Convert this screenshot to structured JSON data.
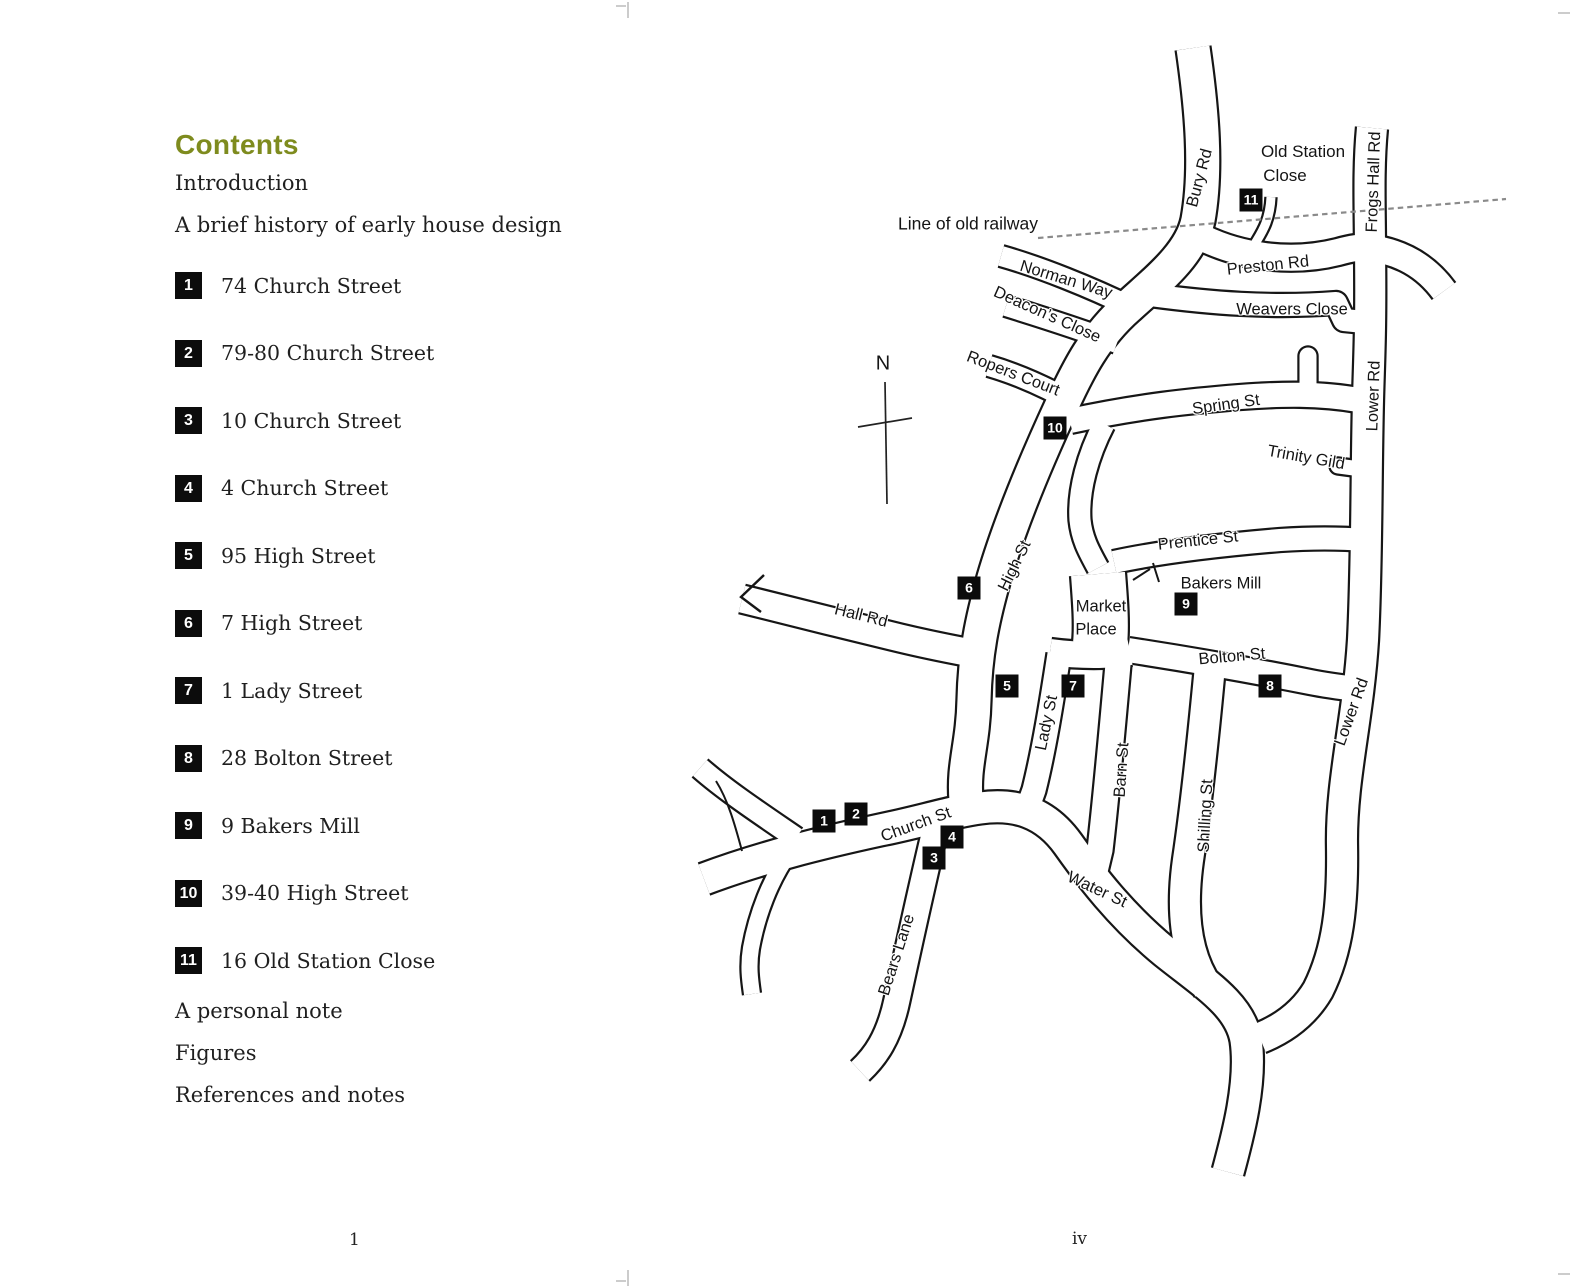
{
  "colors": {
    "accent_olive": "#7e8b1e",
    "ink": "#1f1f1f",
    "map_ink": "#161616",
    "railway_gray": "#8a8a8a"
  },
  "page_left": {
    "title": "Contents",
    "sections_before": [
      "Introduction",
      "A brief history of early house design"
    ],
    "entries": [
      {
        "num": "1",
        "label": "74 Church Street"
      },
      {
        "num": "2",
        "label": "79-80 Church Street"
      },
      {
        "num": "3",
        "label": "10 Church Street"
      },
      {
        "num": "4",
        "label": "4 Church Street"
      },
      {
        "num": "5",
        "label": "95 High Street"
      },
      {
        "num": "6",
        "label": "7 High Street"
      },
      {
        "num": "7",
        "label": "1 Lady Street"
      },
      {
        "num": "8",
        "label": "28 Bolton Street"
      },
      {
        "num": "9",
        "label": "9 Bakers Mill"
      },
      {
        "num": "10",
        "label": "39-40 High Street"
      },
      {
        "num": "11",
        "label": "16 Old Station Close"
      }
    ],
    "sections_after": [
      "A personal note",
      "Figures",
      "References and notes"
    ],
    "page_number": "1"
  },
  "page_right": {
    "page_number": "iv",
    "compass_label": "N",
    "street_labels": [
      {
        "t": "Line of old railway",
        "x": 968,
        "y": 224,
        "r": 0,
        "s": 17.5
      },
      {
        "t": "Bury Rd",
        "x": 1200,
        "y": 178,
        "r": -75
      },
      {
        "t": "Old Station",
        "x": 1303,
        "y": 152,
        "r": 0,
        "s": 17
      },
      {
        "t": "Close",
        "x": 1285,
        "y": 176,
        "r": 0,
        "s": 17
      },
      {
        "t": "Frogs Hall Rd",
        "x": 1374,
        "y": 182,
        "r": -88
      },
      {
        "t": "Norman Way",
        "x": 1066,
        "y": 280,
        "r": 17
      },
      {
        "t": "Preston Rd",
        "x": 1268,
        "y": 266,
        "r": -6
      },
      {
        "t": "Deacon’s Close",
        "x": 1047,
        "y": 315,
        "r": 24
      },
      {
        "t": "Weavers Close",
        "x": 1292,
        "y": 310,
        "r": 0
      },
      {
        "t": "Ropers Court",
        "x": 1013,
        "y": 374,
        "r": 21
      },
      {
        "t": "Spring St",
        "x": 1226,
        "y": 405,
        "r": -8
      },
      {
        "t": "Lower Rd",
        "x": 1374,
        "y": 396,
        "r": -88
      },
      {
        "t": "Trinity Gild",
        "x": 1306,
        "y": 458,
        "r": 10
      },
      {
        "t": "Prentice St",
        "x": 1198,
        "y": 541,
        "r": -6
      },
      {
        "t": "High St",
        "x": 1015,
        "y": 566,
        "r": -64
      },
      {
        "t": "Bakers Mill",
        "x": 1221,
        "y": 584,
        "r": 0
      },
      {
        "t": "Market",
        "x": 1101,
        "y": 607,
        "r": 0
      },
      {
        "t": "Place",
        "x": 1096,
        "y": 630,
        "r": 0
      },
      {
        "t": "Hall Rd",
        "x": 861,
        "y": 616,
        "r": 14
      },
      {
        "t": "Bolton St",
        "x": 1232,
        "y": 657,
        "r": -5
      },
      {
        "t": "Lady St",
        "x": 1047,
        "y": 723,
        "r": -78
      },
      {
        "t": "Barn St",
        "x": 1122,
        "y": 770,
        "r": -86
      },
      {
        "t": "Shilling St",
        "x": 1206,
        "y": 816,
        "r": -87
      },
      {
        "t": "Lower Rd",
        "x": 1352,
        "y": 712,
        "r": -70
      },
      {
        "t": "Church St",
        "x": 916,
        "y": 825,
        "r": -20
      },
      {
        "t": "Water St",
        "x": 1097,
        "y": 890,
        "r": 25
      },
      {
        "t": "Bears Lane",
        "x": 897,
        "y": 955,
        "r": -72
      }
    ],
    "markers": [
      {
        "n": "1",
        "x": 824,
        "y": 821
      },
      {
        "n": "2",
        "x": 856,
        "y": 814
      },
      {
        "n": "3",
        "x": 934,
        "y": 858
      },
      {
        "n": "4",
        "x": 952,
        "y": 837
      },
      {
        "n": "5",
        "x": 1007,
        "y": 686
      },
      {
        "n": "6",
        "x": 969,
        "y": 588
      },
      {
        "n": "7",
        "x": 1073,
        "y": 686
      },
      {
        "n": "8",
        "x": 1270,
        "y": 686
      },
      {
        "n": "9",
        "x": 1186,
        "y": 604
      },
      {
        "n": "10",
        "x": 1055,
        "y": 428
      },
      {
        "n": "11",
        "x": 1251,
        "y": 200
      }
    ]
  }
}
